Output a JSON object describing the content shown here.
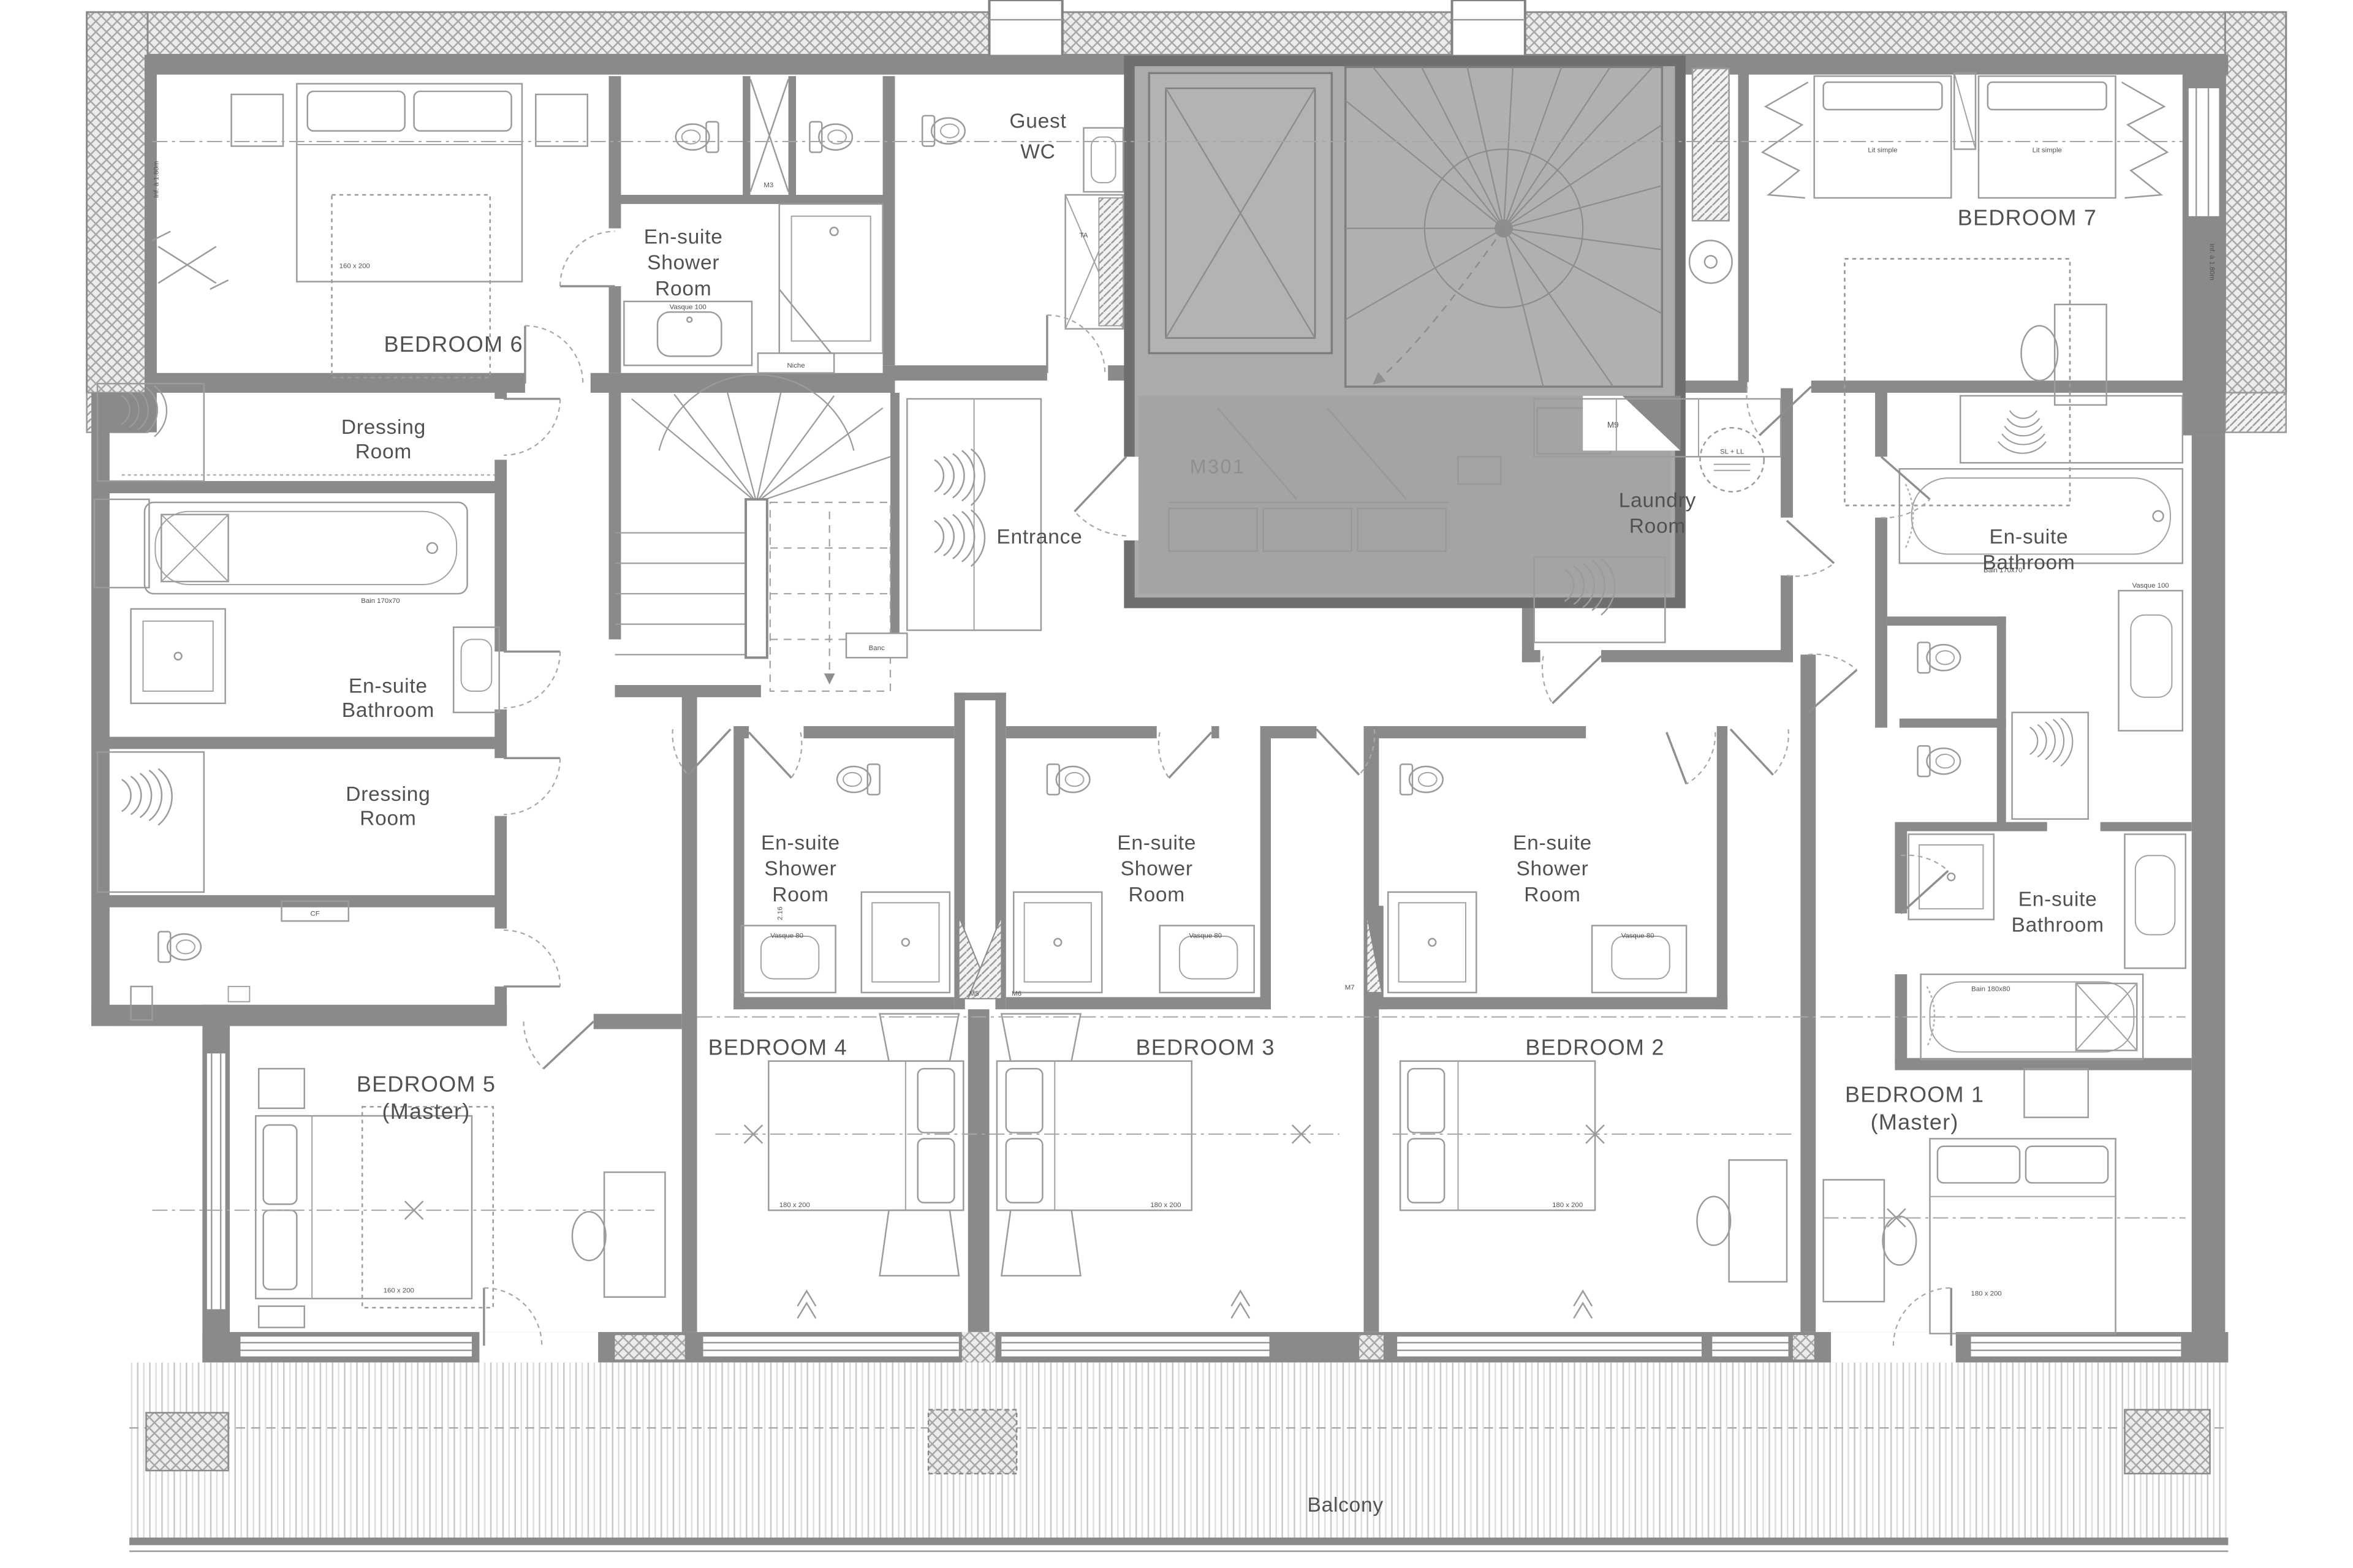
{
  "labels": {
    "bedroom6": "BEDROOM 6",
    "bedroom7": "BEDROOM 7",
    "bedroom5_l1": "BEDROOM 5",
    "bedroom5_l2": "(Master)",
    "bedroom4": "BEDROOM 4",
    "bedroom3": "BEDROOM 3",
    "bedroom2": "BEDROOM 2",
    "bedroom1_l1": "BEDROOM 1",
    "bedroom1_l2": "(Master)",
    "guest_wc_l1": "Guest",
    "guest_wc_l2": "WC",
    "ensuite_shower_l1": "En-suite",
    "ensuite_shower_l2": "Shower",
    "ensuite_shower_l3": "Room",
    "ensuite_bath_l1": "En-suite",
    "ensuite_bath_l2": "Bathroom",
    "dressing_l1": "Dressing",
    "dressing_l2": "Room",
    "laundry_l1": "Laundry",
    "laundry_l2": "Room",
    "entrance": "Entrance",
    "balcony": "Balcony"
  },
  "tags": {
    "m301": "M301",
    "m3": "M3",
    "m5": "M5",
    "m6": "M6",
    "m7": "M7",
    "m9": "M9",
    "ta": "TA",
    "cf": "CF",
    "sl_ll": "SL + LL",
    "niche": "Niche",
    "banc": "Banc"
  },
  "dims": {
    "bed_160": "160 x 200",
    "bed_180": "180 x 200",
    "lit_simple": "Lit simple",
    "vasque_100": "Vasque 100",
    "vasque_80": "Vasque 80",
    "bain_170": "Bain 170x70",
    "bain_180": "Bain 180x80",
    "width_216": "2.16",
    "headroom": "Inf. à 1.80m"
  },
  "colors": {
    "wall": "#8a8a8a",
    "line": "#9b9b9b",
    "text": "#515151",
    "core_fill": "#ababab",
    "core_inner": "#a4a4a4",
    "core_border": "#6f6f6f",
    "paper": "#ffffff"
  }
}
